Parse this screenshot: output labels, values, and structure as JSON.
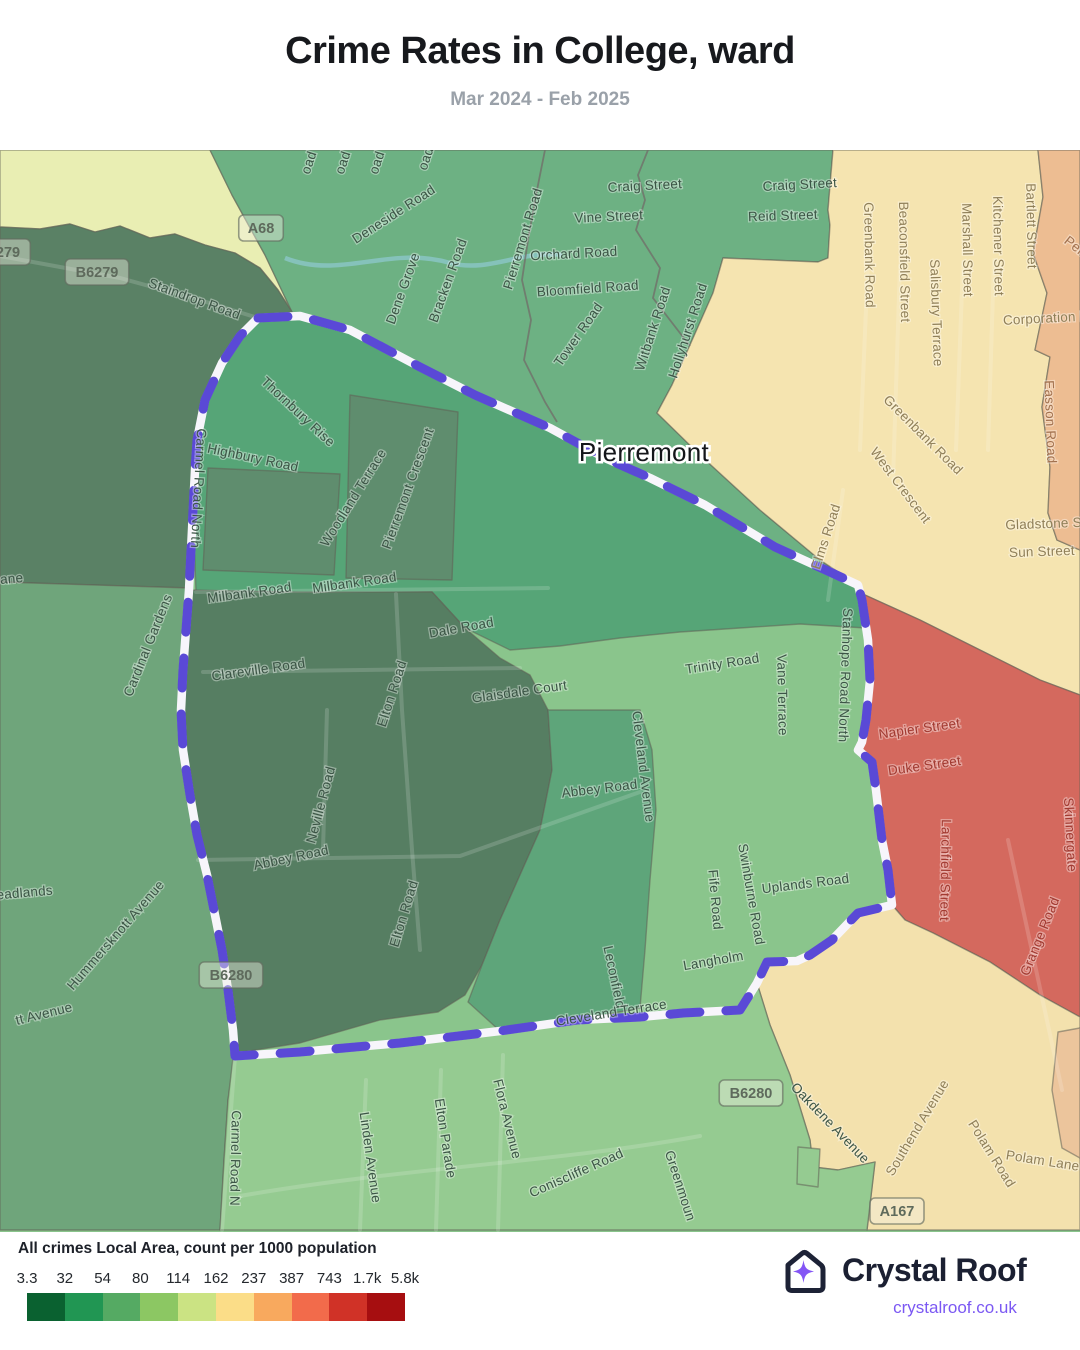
{
  "header": {
    "title": "Crime Rates in College, ward",
    "subtitle": "Mar 2024 - Feb 2025"
  },
  "legend": {
    "title": "All crimes Local Area, count per 1000 population",
    "labels": [
      "3.3",
      "32",
      "54",
      "80",
      "114",
      "162",
      "237",
      "387",
      "743",
      "1.7k",
      "5.8k"
    ],
    "colors": [
      "#0a6130",
      "#219653",
      "#55aa63",
      "#8cc763",
      "#cbe383",
      "#fbdd88",
      "#f8a95e",
      "#f26b4b",
      "#d03227",
      "#a60e10"
    ]
  },
  "brand": {
    "name": "Crystal Roof",
    "url": "crystalroof.co.uk",
    "accent": "#8455f5",
    "navy": "#1b2032"
  },
  "map": {
    "background": "#8ac58c",
    "label_colors": {
      "g": "#3c5546",
      "c": "#8f7f58",
      "o": "#a2714e",
      "r": "#a23a31"
    },
    "boundary": {
      "road_color": "#f7f5fb",
      "dash_color": "#5a49d6",
      "path": "M258,168 L300,166 L350,180 L420,217 L475,245 L550,278 L605,308 L650,328 L705,355 L775,397 L830,422 L858,435 L862,450 L868,490 L870,530 L866,570 L862,592 L858,600 L872,612 L876,640 L882,690 L888,720 L892,755 L858,763 L832,790 L810,805 L797,811 L767,812 L757,833 L740,860 L683,863 L640,867 L577,870 L500,881 L400,893 L300,902 L235,906 L233,880 L228,840 L222,800 L215,765 L207,725 L197,685 L190,645 L183,600 L181,560 L183,520 L186,480 L189,440 L191,400 L193,360 L195,320 L197,290 L205,250 L222,213 L240,186 Z"
    },
    "place": {
      "label": "Pierremont",
      "x": 644,
      "y": 311
    },
    "regions": [
      {
        "n": "area-pale-northwest",
        "f": "#e9eeb3",
        "pts": "0,0 210,0 232,45 265,105 292,162 278,140 260,118 235,103 205,95 175,84 150,88 120,76 95,82 70,74 40,79 0,77"
      },
      {
        "n": "area-green-north",
        "f": "#6db183",
        "pts": "210,0 833,0 828,60 830,75 828,108 818,112 723,108 713,143 690,195 672,235 657,263 700,305 760,360 820,410 858,435 830,422 775,397 705,355 650,328 605,308 550,278 475,245 420,217 350,180 300,166 258,168 292,162 265,105 232,45"
      },
      {
        "n": "area-dark-northwest",
        "f": "#5a8165",
        "pts": "0,77 40,79 70,74 95,82 120,76 150,88 175,84 205,95 235,103 260,118 278,140 292,162 258,168 240,186 222,213 205,250 197,290 195,320 193,360 191,400 189,438 0,432"
      },
      {
        "n": "area-west",
        "f": "#6fa57b",
        "pts": "0,432 189,438 186,480 183,520 181,560 183,600 190,645 197,685 207,725 215,765 222,800 228,840 233,880 235,906 228,950 224,1010 220,1080 0,1080"
      },
      {
        "n": "area-cream-northeast",
        "f": "#f5e4b0",
        "pts": "833,0 1038,0 1043,47 1033,103 1047,143 1035,200 1050,207 1042,257 1050,317 1048,363 1057,390 1080,400 1080,545 1040,530 980,500 920,470 865,445 858,435 820,410 760,360 700,305 657,263 672,235 690,195 713,143 723,108 818,112 828,108 830,75 828,60"
      },
      {
        "n": "area-orange-northeast",
        "f": "#edbd92",
        "pts": "1038,0 1080,0 1080,400 1057,390 1048,363 1050,317 1042,257 1050,207 1035,200 1047,143 1033,103 1043,47"
      },
      {
        "n": "area-red-east",
        "f": "#d4695e",
        "pts": "865,445 920,470 980,500 1040,530 1080,545 1080,867 1040,845 990,812 933,783 905,770 892,755 888,720 882,690 876,640 872,612 858,600 862,592 866,570 870,530 868,490 862,450"
      },
      {
        "n": "area-beige-southeast",
        "f": "#f3e1ad",
        "pts": "905,770 933,783 990,812 1040,845 1080,867 1080,1080 867,1080 875,1012 838,1020 813,1017 810,990 790,925 770,875 757,833 767,812 797,811 810,805 832,790 858,763 892,755"
      },
      {
        "n": "area-orange-southeast",
        "f": "#ecc59c",
        "pts": "1058,882 1080,878 1080,1008 1062,998 1052,940"
      },
      {
        "n": "area-green-south",
        "f": "#95cb91",
        "pts": "235,906 300,902 400,893 500,881 577,870 640,867 683,863 740,860 757,833 770,875 790,925 810,990 813,1017 838,1020 875,1012 867,1080 220,1080 224,1010 228,950 233,908"
      },
      {
        "n": "area-green-notch",
        "f": "#95cb91",
        "pts": "798,997 820,999 818,1037 797,1034"
      },
      {
        "n": "ward-base",
        "f": "#8ac58c",
        "pts": "258,168 300,166 350,180 420,217 475,245 550,278 605,308 650,328 705,355 775,397 830,422 858,435 862,450 868,490 870,530 866,570 862,592 858,600 872,612 876,640 882,690 888,720 892,755 858,763 832,790 810,805 797,811 767,812 757,833 740,860 683,863 640,867 577,870 500,881 400,893 300,902 235,906 233,880 228,840 222,800 215,765 207,725 197,685 190,645 183,600 181,560 183,520 186,480 189,440 191,400 193,360 195,320 197,290 205,250 222,213 240,186"
      },
      {
        "n": "ward-teal-north",
        "f": "#56a577",
        "pts": "258,168 300,166 350,180 420,217 475,245 550,278 605,308 650,328 705,355 775,397 830,422 858,435 862,450 866,478 800,474 740,478 680,482 620,488 560,496 510,500 465,478 432,442 300,444 196,442 193,360 195,320 197,290 205,250 222,213 240,186"
      },
      {
        "n": "ward-dark-center",
        "f": "#567e62",
        "pts": "189,440 300,442 432,442 465,478 500,508 530,525 548,560 552,620 540,680 520,725 500,770 482,815 465,845 438,862 380,870 300,893 237,903 233,880 228,840 222,800 215,765 207,725 197,685 190,645 183,600 181,560 183,520 186,480"
      },
      {
        "n": "ward-medium-strip",
        "f": "#5ea57a",
        "pts": "548,560 640,560 652,600 656,660 650,730 645,800 640,858 577,870 540,874 500,881 468,852 482,815 500,770 520,725 540,680 552,620"
      },
      {
        "n": "ward-dark-patch-a",
        "f": "#5f8d6e",
        "pts": "208,318 340,324 334,425 203,420"
      },
      {
        "n": "ward-dark-patch-b",
        "f": "#5f8d6e",
        "pts": "350,245 458,262 452,430 346,428"
      }
    ],
    "stream": "M285,108 C340,130 390,95 450,113 C490,123 520,100 562,105",
    "roads": [
      "M0,106 L120,128 L200,150 L258,168",
      "M196,442 L548,438",
      "M203,522 L520,518",
      "M198,710 L460,706 L640,642",
      "M240,1046 C400,1018 560,1012 700,986",
      "M235,906 L222,1080",
      "M396,444 L402,560 L412,700 L420,800",
      "M327,560 L323,700",
      "M366,930 L360,1080",
      "M441,920 L436,1080",
      "M503,905 L498,1080",
      "M843,340 L828,450",
      "M1008,690 L1062,940",
      "M868,112 L860,300",
      "M900,115 L893,330",
      "M963,112 L956,300",
      "M994,110 L988,300"
    ],
    "gray_lines": [
      "M648,0 L638,25 L645,50 L636,80 L660,118 L653,148 L690,196",
      "M545,0 L536,45 L528,90 L522,130 L531,170 L524,210 L545,252 L557,272"
    ],
    "badges": [
      {
        "t": "279",
        "x": 8,
        "y": 102
      },
      {
        "t": "B6279",
        "x": 97,
        "y": 122
      },
      {
        "t": "A68",
        "x": 261,
        "y": 78
      },
      {
        "t": "B6280",
        "x": 231,
        "y": 825
      },
      {
        "t": "B6280",
        "x": 751,
        "y": 943
      },
      {
        "t": "A167",
        "x": 897,
        "y": 1061
      }
    ],
    "streets": [
      {
        "t": "Staindrop Road",
        "x": 193,
        "y": 153,
        "r": 20
      },
      {
        "t": "Deneside Road",
        "x": 396,
        "y": 68,
        "r": -33
      },
      {
        "t": "Dene Grove",
        "x": 407,
        "y": 140,
        "r": -70
      },
      {
        "t": "Bracken Road",
        "x": 452,
        "y": 132,
        "r": -70
      },
      {
        "t": "Pierremont Road",
        "x": 527,
        "y": 90,
        "r": -73
      },
      {
        "t": "oad",
        "x": 313,
        "y": 14,
        "r": -72
      },
      {
        "t": "oad",
        "x": 347,
        "y": 14,
        "r": -72
      },
      {
        "t": "oad",
        "x": 381,
        "y": 14,
        "r": -72
      },
      {
        "t": "oad",
        "x": 430,
        "y": 10,
        "r": -72
      },
      {
        "t": "Craig Street",
        "x": 645,
        "y": 40,
        "r": -3
      },
      {
        "t": "Craig Street",
        "x": 800,
        "y": 39,
        "r": -3
      },
      {
        "t": "Vine Street",
        "x": 609,
        "y": 71,
        "r": -3
      },
      {
        "t": "Reid Street",
        "x": 783,
        "y": 70,
        "r": -2
      },
      {
        "t": "Orchard Road",
        "x": 574,
        "y": 108,
        "r": -3
      },
      {
        "t": "Bloomfield Road",
        "x": 588,
        "y": 143,
        "r": -4
      },
      {
        "t": "Tower Road",
        "x": 582,
        "y": 187,
        "r": -55
      },
      {
        "t": "Witbank Road",
        "x": 657,
        "y": 180,
        "r": -72
      },
      {
        "t": "Hollyhurst Road",
        "x": 692,
        "y": 182,
        "r": -72
      },
      {
        "t": "Thornbury Rise",
        "x": 295,
        "y": 265,
        "r": 43
      },
      {
        "t": "Highbury Road",
        "x": 252,
        "y": 312,
        "r": 12
      },
      {
        "t": "Woodland Terrace",
        "x": 357,
        "y": 350,
        "r": -58
      },
      {
        "t": "Pierremont Crescent",
        "x": 412,
        "y": 340,
        "r": -70
      },
      {
        "t": "Cardinal Gardens",
        "x": 152,
        "y": 497,
        "r": -68
      },
      {
        "t": "ane",
        "x": 12,
        "y": 433,
        "r": -5
      },
      {
        "t": "Milbank Road",
        "x": 250,
        "y": 447,
        "r": -8
      },
      {
        "t": "Milbank Road",
        "x": 355,
        "y": 437,
        "r": -8
      },
      {
        "t": "Dale Road",
        "x": 462,
        "y": 482,
        "r": -10
      },
      {
        "t": "Clareville Road",
        "x": 259,
        "y": 524,
        "r": -8
      },
      {
        "t": "Glaisdale Court",
        "x": 520,
        "y": 546,
        "r": -8
      },
      {
        "t": "Elton Road",
        "x": 396,
        "y": 545,
        "r": -72
      },
      {
        "t": "Carmel Road North",
        "x": 194,
        "y": 338,
        "r": 93
      },
      {
        "t": "Neville Road",
        "x": 325,
        "y": 656,
        "r": -75
      },
      {
        "t": "Abbey Road",
        "x": 292,
        "y": 712,
        "r": -12
      },
      {
        "t": "Abbey Road",
        "x": 600,
        "y": 643,
        "r": -7
      },
      {
        "t": "Cleveland Avenue",
        "x": 639,
        "y": 617,
        "r": 83
      },
      {
        "t": "Elton Road",
        "x": 408,
        "y": 765,
        "r": -73
      },
      {
        "t": "eadlands",
        "x": 25,
        "y": 747,
        "r": -5
      },
      {
        "t": "Hummersknott Avenue",
        "x": 119,
        "y": 788,
        "r": -49
      },
      {
        "t": "tt Avenue",
        "x": 45,
        "y": 868,
        "r": -14
      },
      {
        "t": "Trinity Road",
        "x": 723,
        "y": 518,
        "r": -9
      },
      {
        "t": "Vane Terrace",
        "x": 778,
        "y": 545,
        "r": 89
      },
      {
        "t": "Stanhope Road North",
        "x": 841,
        "y": 525,
        "r": 92
      },
      {
        "t": "Elms Road",
        "x": 830,
        "y": 388,
        "r": -72,
        "c": "c"
      },
      {
        "t": "Swinburne Road",
        "x": 747,
        "y": 745,
        "r": 80
      },
      {
        "t": "Fife Road",
        "x": 711,
        "y": 750,
        "r": 85
      },
      {
        "t": "Uplands Road",
        "x": 806,
        "y": 738,
        "r": -7
      },
      {
        "t": "Leconfield",
        "x": 610,
        "y": 828,
        "r": 78
      },
      {
        "t": "Langholm",
        "x": 714,
        "y": 815,
        "r": -10
      },
      {
        "t": "Cleveland Terrace",
        "x": 612,
        "y": 867,
        "r": -9
      },
      {
        "t": "Carmel Road N",
        "x": 231,
        "y": 1008,
        "r": 91
      },
      {
        "t": "Linden Avenue",
        "x": 366,
        "y": 1008,
        "r": 82
      },
      {
        "t": "Elton Parade",
        "x": 441,
        "y": 989,
        "r": 81
      },
      {
        "t": "Flora Avenue",
        "x": 503,
        "y": 970,
        "r": 76
      },
      {
        "t": "Coniscliffe Road",
        "x": 578,
        "y": 1027,
        "r": -24
      },
      {
        "t": "Greenmoun",
        "x": 676,
        "y": 1037,
        "r": 72
      },
      {
        "t": "Oakdene Avenue",
        "x": 827,
        "y": 976,
        "r": 46
      },
      {
        "t": "Greenbank Road",
        "x": 865,
        "y": 105,
        "r": 89,
        "c": "c"
      },
      {
        "t": "Beaconsfield Street",
        "x": 900,
        "y": 112,
        "r": 89,
        "c": "c"
      },
      {
        "t": "Salisbury Terrace",
        "x": 932,
        "y": 163,
        "r": 88,
        "c": "c"
      },
      {
        "t": "Marshall Street",
        "x": 963,
        "y": 100,
        "r": 89,
        "c": "c"
      },
      {
        "t": "Kitchener Street",
        "x": 994,
        "y": 96,
        "r": 89,
        "c": "c"
      },
      {
        "t": "Bartlett Street",
        "x": 1027,
        "y": 76,
        "r": 89,
        "c": "c"
      },
      {
        "t": "Corporation Road",
        "x": 1058,
        "y": 172,
        "r": -3,
        "c": "c"
      },
      {
        "t": "Gladstone Str",
        "x": 1048,
        "y": 378,
        "r": -2,
        "c": "c"
      },
      {
        "t": "Sun Street",
        "x": 1042,
        "y": 406,
        "r": -2,
        "c": "c"
      },
      {
        "t": "Greenbank Road",
        "x": 920,
        "y": 288,
        "r": 45,
        "c": "c"
      },
      {
        "t": "West Crescent",
        "x": 897,
        "y": 338,
        "r": 53,
        "c": "c"
      },
      {
        "t": "Southend Avenue",
        "x": 921,
        "y": 980,
        "r": -59,
        "c": "c"
      },
      {
        "t": "Polam Road",
        "x": 988,
        "y": 1006,
        "r": 58,
        "c": "c"
      },
      {
        "t": "Polam Lane",
        "x": 1042,
        "y": 1015,
        "r": 9,
        "c": "c"
      },
      {
        "t": "Pen",
        "x": 1073,
        "y": 100,
        "r": 38,
        "c": "o"
      },
      {
        "t": "Easson Road",
        "x": 1046,
        "y": 272,
        "r": 88,
        "c": "o"
      },
      {
        "t": "Napier Street",
        "x": 920,
        "y": 583,
        "r": -8,
        "c": "r"
      },
      {
        "t": "Duke Street",
        "x": 925,
        "y": 620,
        "r": -8,
        "c": "r"
      },
      {
        "t": "Larchfield Street",
        "x": 941,
        "y": 720,
        "r": 91,
        "c": "r"
      },
      {
        "t": "Skinnergate",
        "x": 1066,
        "y": 685,
        "r": 87,
        "c": "r"
      },
      {
        "t": "Grange Road",
        "x": 1044,
        "y": 788,
        "r": -68,
        "c": "r"
      }
    ]
  }
}
